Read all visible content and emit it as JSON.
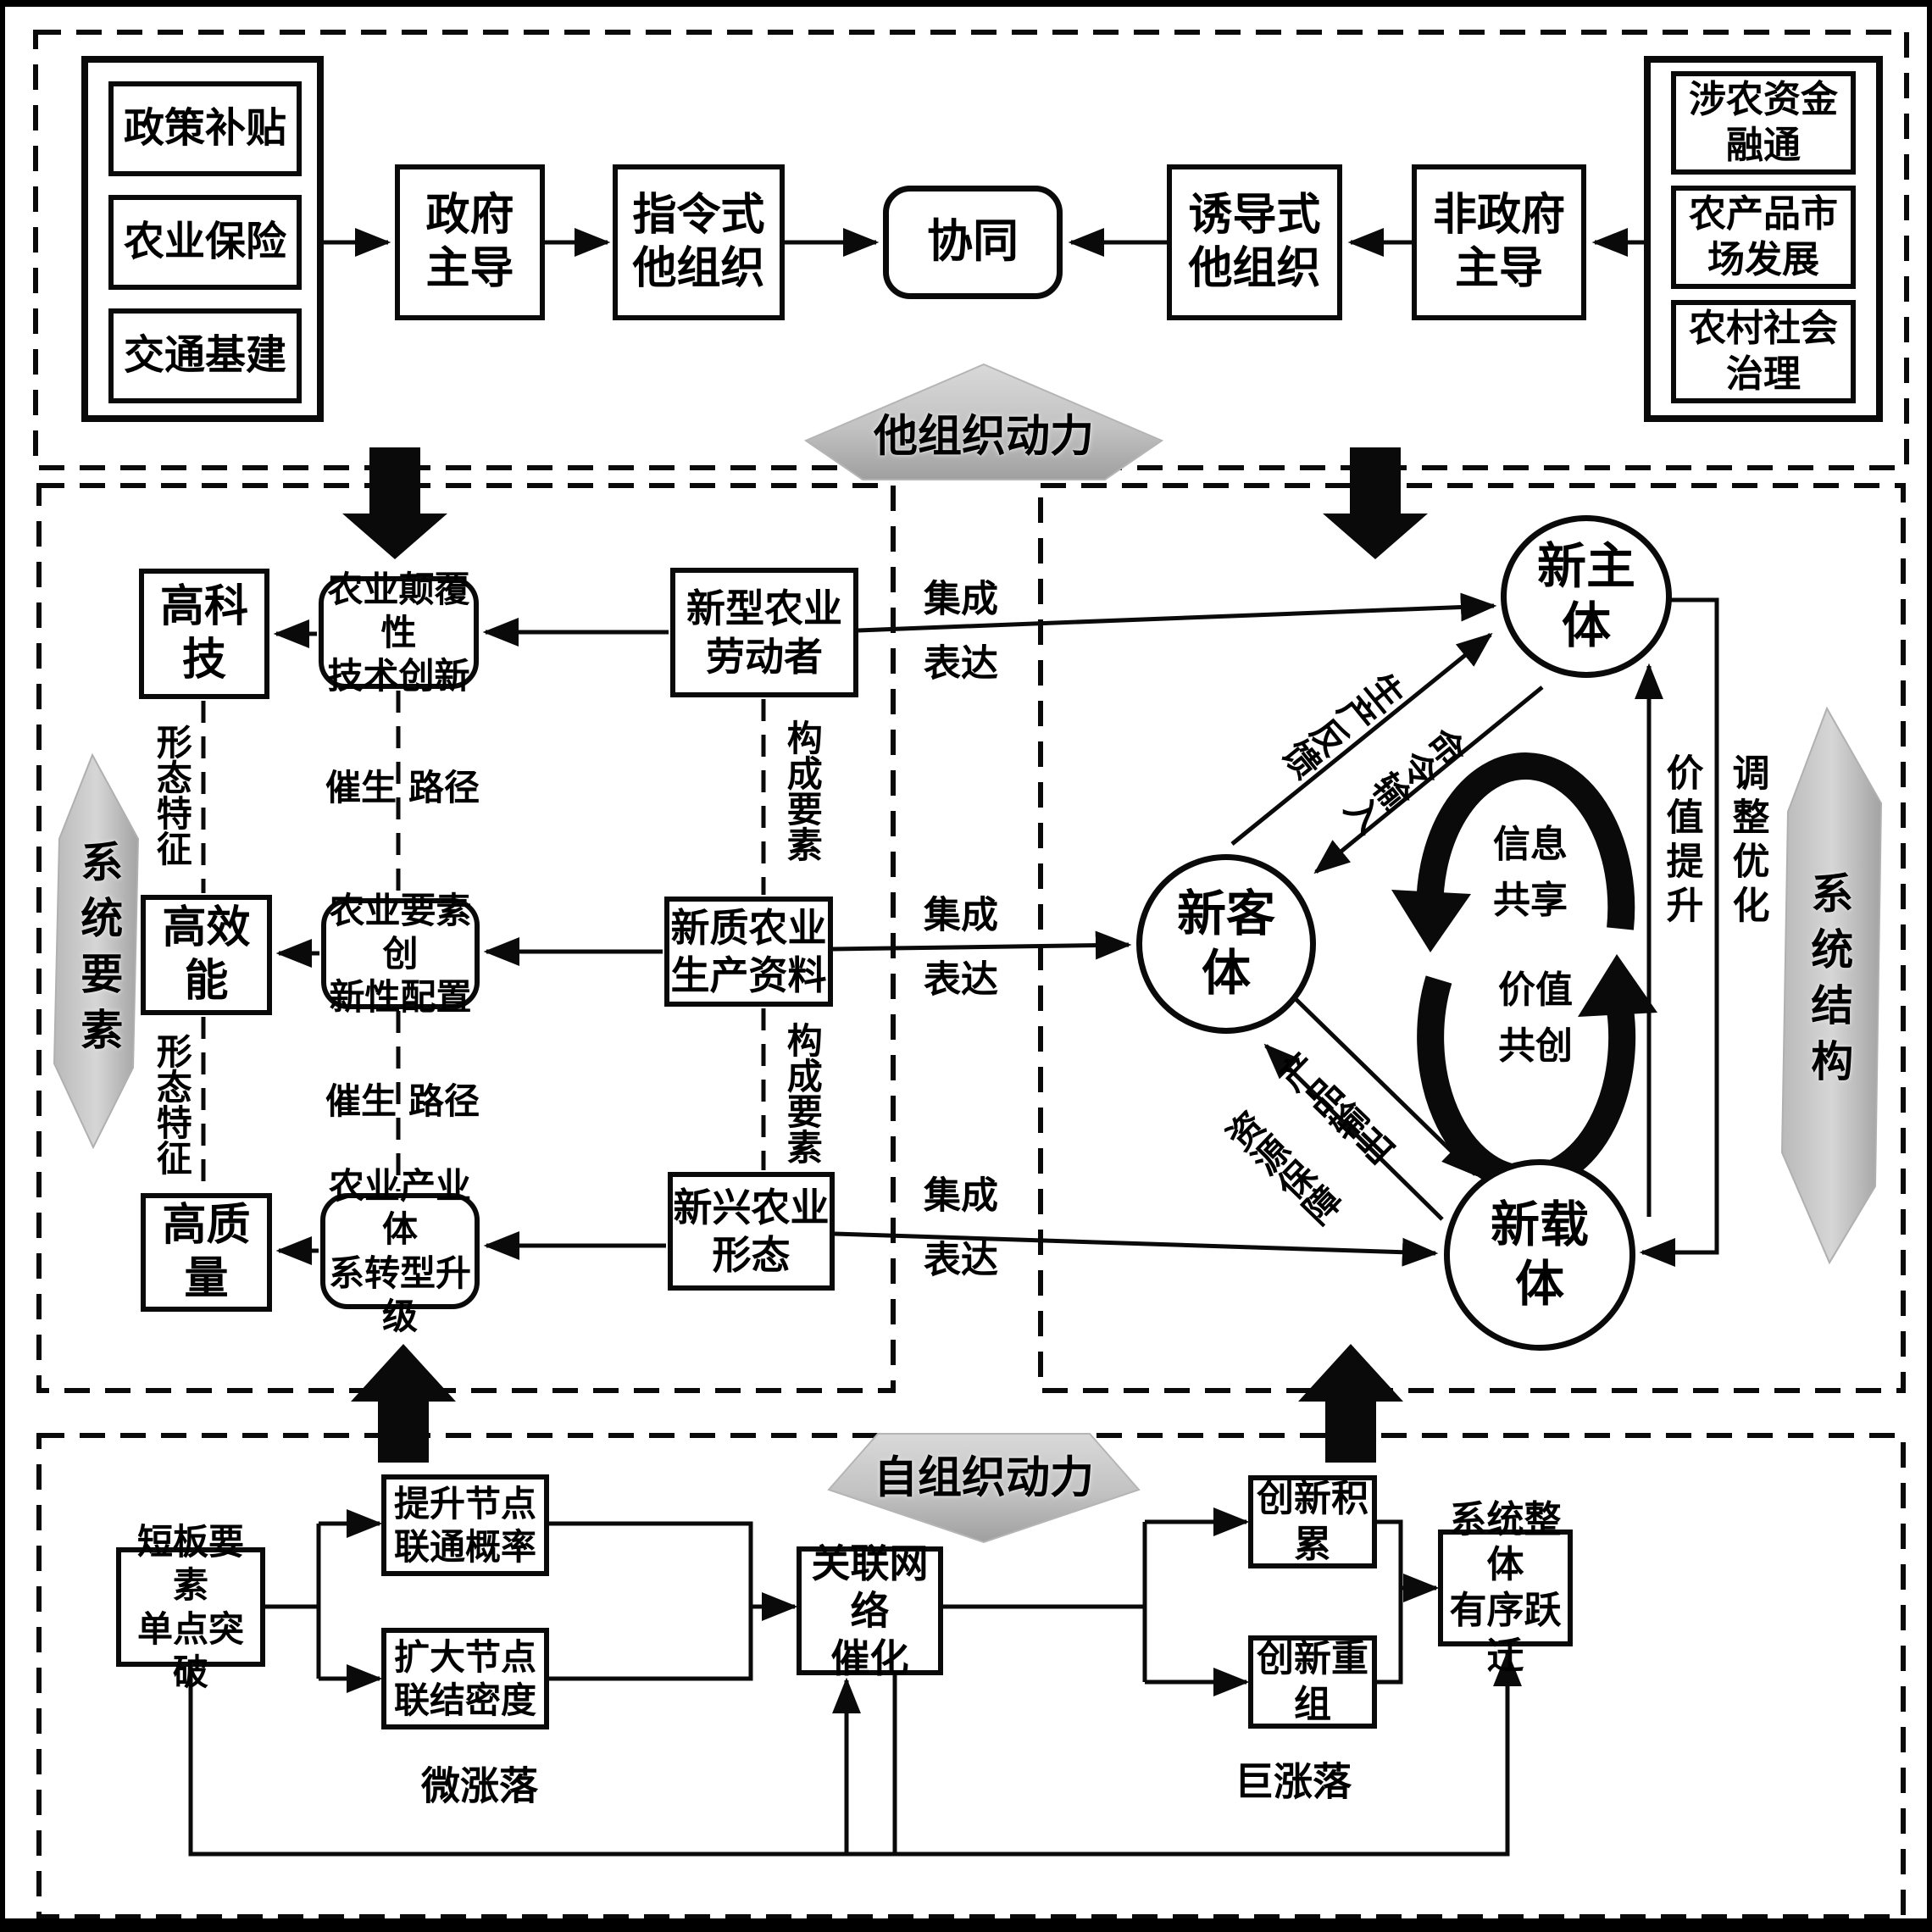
{
  "top": {
    "left_inputs": [
      "政策补贴",
      "农业保险",
      "交通基建"
    ],
    "gov_led": "政府\n主导",
    "directive": "指令式\n他组织",
    "synergy": "协同",
    "induced": "诱导式\n他组织",
    "non_gov_led": "非政府\n主导",
    "right_inputs": [
      "涉农资金\n融通",
      "农产品市\n场发展",
      "农村社会\n治理"
    ],
    "force_label": "他组织动力"
  },
  "middle_left": {
    "side_label": "系统要素",
    "rows": [
      {
        "feature": "高科技",
        "mechanism": "农业颠覆性\n技术创新",
        "element": "新型农业\n劳动者"
      },
      {
        "feature": "高效能",
        "mechanism": "农业要素创\n新性配置",
        "element": "新质农业\n生产资料"
      },
      {
        "feature": "高质量",
        "mechanism": "农业产业体\n系转型升级",
        "element": "新兴农业\n形态"
      }
    ],
    "morph_label": "形态特征",
    "catalyze_label": "催生",
    "path_label": "路径",
    "component_label": "构成要素",
    "integration_label": "集成\n表达"
  },
  "middle_right": {
    "side_label": "系统结构",
    "subject": "新主\n体",
    "object": "新客\n体",
    "carrier": "新载\n体",
    "production_feedback": "生产反馈",
    "command_input": "命令输入",
    "product_output": "产品输出",
    "resource_support": "资源保障",
    "info_sharing": "信息\n共享",
    "value_cocreation": "价值\n共创",
    "value_promotion": "价值提升",
    "adjust_optimize": "调整优化"
  },
  "bottom": {
    "force_label": "自组织动力",
    "breakthrough": "短板要素\n单点突破",
    "raise_probability": "提升节点\n联通概率",
    "expand_density": "扩大节点\n联结密度",
    "network_catalysis": "关联网络\n催化",
    "innovation_accumulation": "创新积累",
    "innovation_recombination": "创新重组",
    "system_leap": "系统整体\n有序跃迁",
    "micro_fluctuation": "微涨落",
    "macro_fluctuation": "巨涨落"
  },
  "colors": {
    "line": "#0a0a0a",
    "pentagon_gray": "#c7c7c7",
    "background": "#ffffff"
  }
}
